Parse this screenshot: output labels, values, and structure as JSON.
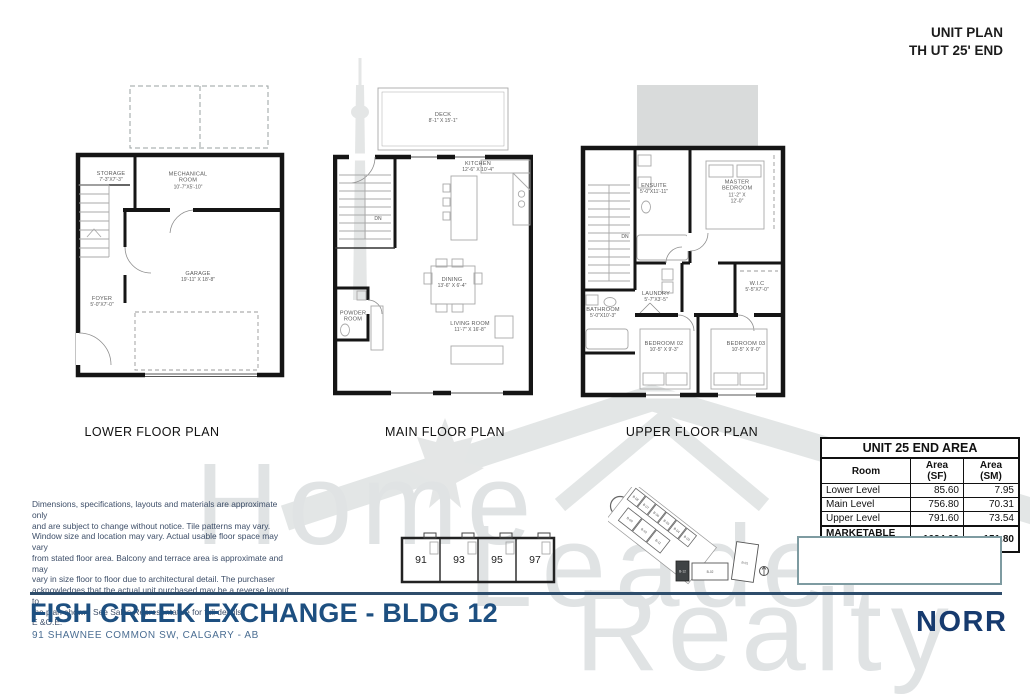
{
  "header": {
    "line1": "UNIT PLAN",
    "line2": "TH UT 25' END"
  },
  "plans": {
    "lower": {
      "label": "LOWER FLOOR PLAN",
      "rooms": [
        {
          "name": "STORAGE",
          "dims": "7'-3\"X7'-3\""
        },
        {
          "name": "MECHANICAL ROOM",
          "dims": "10'-7\"X5'-10\""
        },
        {
          "name": "GARAGE",
          "dims": "19'-11\" X 18'-8\""
        },
        {
          "name": "FOYER",
          "dims": "5'-0\"X7'-0\""
        }
      ]
    },
    "main": {
      "label": "MAIN FLOOR PLAN",
      "rooms": [
        {
          "name": "DECK",
          "dims": "8'-1\" X 15'-1\""
        },
        {
          "name": "KITCHEN",
          "dims": "12'-6\" X 10'-4\""
        },
        {
          "name": "DINING",
          "dims": "13'-6\" X 6'-4\""
        },
        {
          "name": "LIVING ROOM",
          "dims": "11'-7\" X 16'-8\""
        },
        {
          "name": "POWDER ROOM",
          "dims": ""
        }
      ]
    },
    "upper": {
      "label": "UPPER FLOOR PLAN",
      "rooms": [
        {
          "name": "ENSUITE",
          "dims": "5'-0\"X11'-11\""
        },
        {
          "name": "MASTER BEDROOM",
          "dims": "11'-2\" X 12'-0\""
        },
        {
          "name": "W.I.C",
          "dims": "5'-5\"X7'-0\""
        },
        {
          "name": "LAUNDRY",
          "dims": "5'-7\"X3'-5\""
        },
        {
          "name": "BATHROOM",
          "dims": "5'-0\"X10'-3\""
        },
        {
          "name": "BEDROOM 02",
          "dims": "10'-5\" X 9'-3\""
        },
        {
          "name": "BEDROOM 03",
          "dims": "10'-5\" X 9'-0\""
        }
      ]
    },
    "stair_label": "DN"
  },
  "area_table": {
    "title": "UNIT 25 END AREA",
    "columns": [
      "Room",
      "Area (SF)",
      "Area (SM)"
    ],
    "rows": [
      {
        "room": "Lower Level",
        "sf": "85.60",
        "sm": "7.95"
      },
      {
        "room": "Main Level",
        "sf": "756.80",
        "sm": "70.31"
      },
      {
        "room": "Upper Level",
        "sf": "791.60",
        "sm": "73.54"
      }
    ],
    "total": {
      "room": "MARKETABLE AREA",
      "sf": "1634.00",
      "sm": "151.80"
    }
  },
  "unit_strip": {
    "units": [
      "91",
      "93",
      "95",
      "97"
    ]
  },
  "site_plan": {
    "highlighted": "B-12",
    "buildings": [
      "B-08",
      "B-07",
      "B-06",
      "B-05",
      "B-04",
      "B-03",
      "B-09",
      "B-10",
      "B-11",
      "B-12",
      "B-02",
      "B-01"
    ]
  },
  "disclaimer": "Dimensions, specifications, layouts and materials are approximate only\nand are subject to change without notice.  Tile patterns may vary.\nWindow size and location may vary.  Actual usable floor space may vary\nfrom stated floor area.  Balcony and terrace area is approximate and may\nvary in size floor to floor due to architectural detail.  The purchaser\nacknowledges that the actual unit purchased may be a reverse layout to\nthe plan shown.  See Sales Representative for full details.\nE &O.E.",
  "footer": {
    "title": "FISH CREEK EXCHANGE - BLDG 12",
    "address": "91 SHAWNEE COMMON SW, CALGARY - AB",
    "logo": "NORR"
  },
  "watermark": {
    "words": [
      "Home",
      "Leader",
      "Realty"
    ]
  },
  "colors": {
    "title_blue": "#1d4f80",
    "logo_blue": "#163a6e",
    "rule_blue": "#2e4d6b",
    "disclaimer_blue": "#3d4e68",
    "note_box_border": "#7e9ba1",
    "wall_black": "#151515",
    "watermark_gray": "#e0e3e4"
  }
}
